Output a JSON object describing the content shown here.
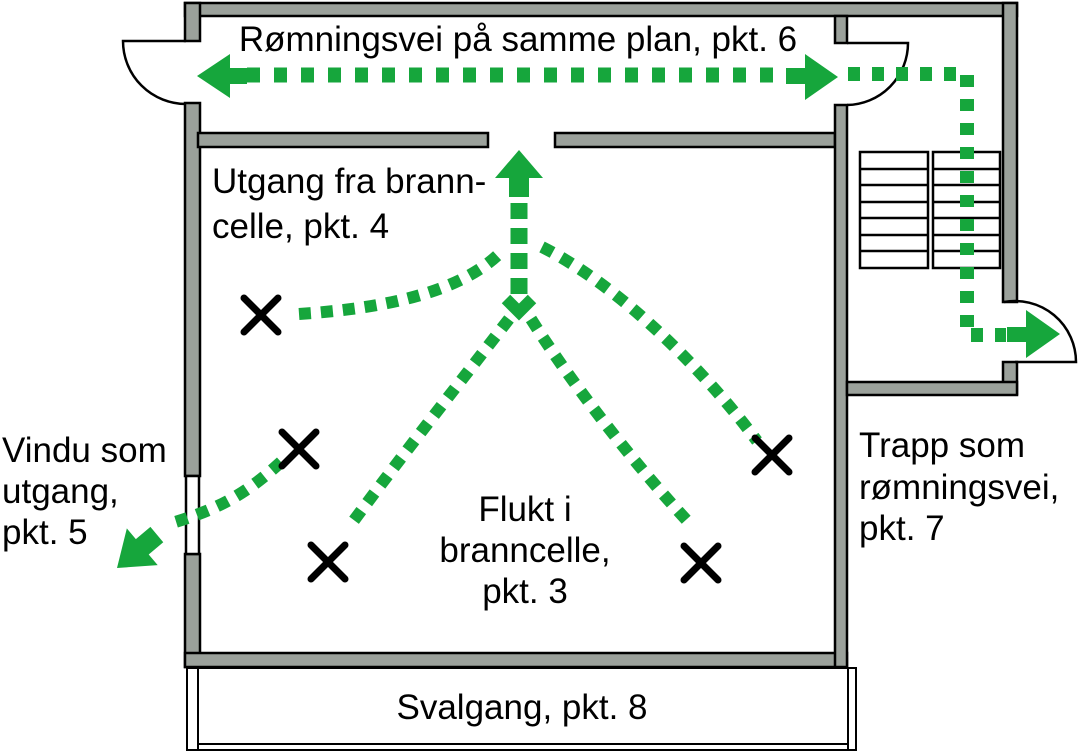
{
  "diagram": {
    "type": "fire-escape-floor-plan",
    "labels": {
      "route_same_floor": "Rømningsvei på samme plan, pkt. 6",
      "exit_fire_cell": [
        "Utgang fra brann-",
        "celle, pkt. 4"
      ],
      "flight_fire_cell": [
        "Flukt i",
        "branncelle,",
        "pkt. 3"
      ],
      "window_exit": [
        "Vindu som",
        "utgang,",
        "pkt. 5"
      ],
      "stair_escape": [
        "Trapp som",
        "rømningsvei,",
        "pkt. 7"
      ],
      "walkway": "Svalgang, pkt. 8"
    },
    "colors": {
      "route_green": "#16a63c",
      "wall_fill": "#9ba19b",
      "wall_outline": "#000000",
      "text": "#000000",
      "background": "#ffffff"
    },
    "markers": {
      "x_mark_count": 5,
      "route_arrow_count": 5
    }
  }
}
